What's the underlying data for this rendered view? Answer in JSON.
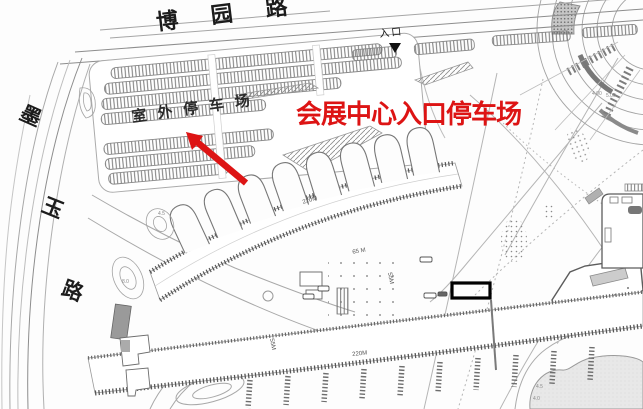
{
  "canvas": {
    "width": 643,
    "height": 409
  },
  "roads": {
    "top_name": "博园路",
    "top_chars": [
      "博",
      "园",
      "路"
    ],
    "left_name": "墨玉路",
    "left_chars": [
      "墨",
      "玉",
      "路"
    ]
  },
  "labels": {
    "outdoor_parking": "室外停车场",
    "entrance": "入口"
  },
  "annotations": {
    "red_label": "会展中心入口停车场",
    "red_color": "#dd1414",
    "highlight_box_color": "#000000"
  },
  "dimensions": {
    "upper_hall": "220M",
    "lower_hall": "220M",
    "courtyard": "65 M",
    "hall_depth": "55M",
    "hall_depth_right": "55M"
  },
  "elevations": [
    "4.00",
    "5.00",
    "4.5",
    "8.0",
    "4.5",
    "4.0"
  ],
  "icons": {
    "entrance_arrow": "black down-arrow under entrance label",
    "red_arrow": "red annotation arrow pointing to outdoor parking",
    "highlight_box": "black rectangle highlight on plan"
  }
}
